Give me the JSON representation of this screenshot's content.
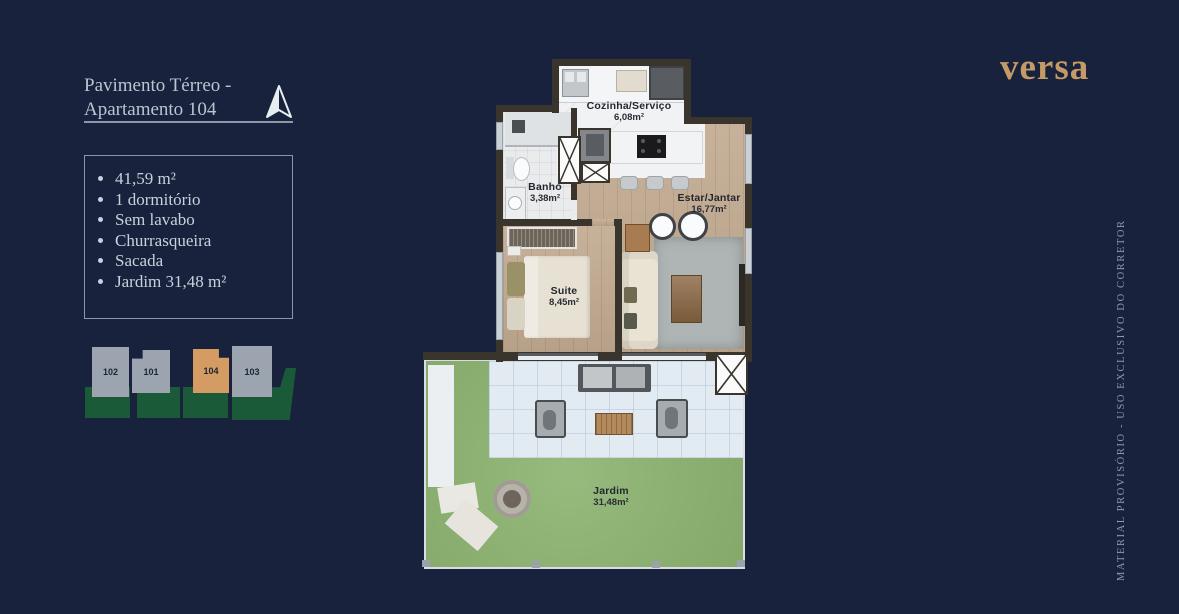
{
  "page": {
    "background_color": "#18223C"
  },
  "brand": {
    "logo_text": "versa",
    "logo_color": "#C49A66"
  },
  "plan_header": {
    "title_line1": "Pavimento Térreo -",
    "title_line2": "Apartamento 104"
  },
  "features": {
    "items": [
      "41,59 m²",
      "1 dormitório",
      "Sem lavabo",
      "Churrasqueira",
      "Sacada",
      "Jardim 31,48 m²"
    ]
  },
  "site_map": {
    "units": [
      {
        "id": "102",
        "highlighted": false
      },
      {
        "id": "101",
        "highlighted": false
      },
      {
        "id": "104",
        "highlighted": true
      },
      {
        "id": "103",
        "highlighted": false
      }
    ],
    "highlight_color": "#D49B63",
    "block_color": "#9CA5AF",
    "garden_color": "#1A5A39"
  },
  "floorplan": {
    "rooms": [
      {
        "name": "Cozinha/Serviço",
        "area": "6,08m²"
      },
      {
        "name": "Banho",
        "area": "3,38m²"
      },
      {
        "name": "Estar/Jantar",
        "area": "16,77m²"
      },
      {
        "name": "Suite",
        "area": "8,45m²"
      },
      {
        "name": "Jardim",
        "area": "31,48m²"
      }
    ]
  },
  "legal": {
    "watermark": "MATERIAL PROVISÓRIO - USO EXCLUSIVO DO CORRETOR"
  }
}
